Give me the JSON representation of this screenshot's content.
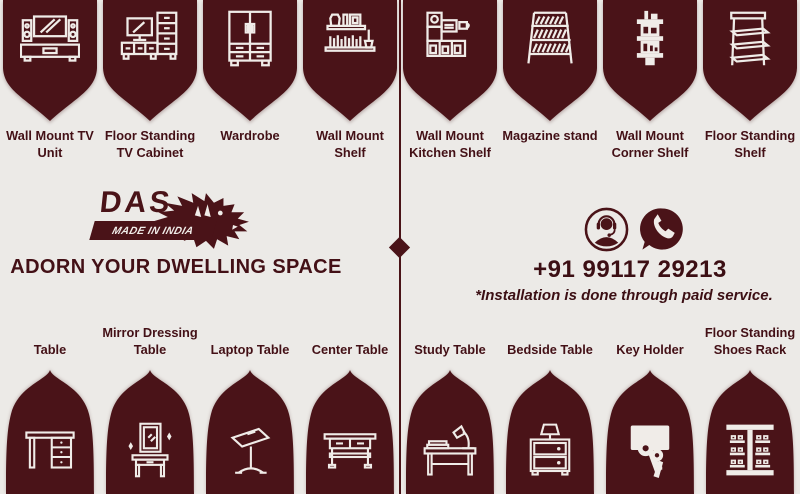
{
  "theme": {
    "maroon": "#4A1318",
    "background": "#ECEAE7",
    "icon_stroke": "#F0ECE8",
    "text_maroon": "#431016"
  },
  "top_categories": [
    {
      "label": "Wall Mount TV Unit",
      "icon": "wall-mount-tv-unit-icon"
    },
    {
      "label": "Floor Standing TV Cabinet",
      "icon": "floor-standing-tv-cabinet-icon"
    },
    {
      "label": "Wardrobe",
      "icon": "wardrobe-icon"
    },
    {
      "label": "Wall Mount Shelf",
      "icon": "wall-mount-shelf-icon"
    },
    {
      "label": "Wall Mount Kitchen Shelf",
      "icon": "wall-mount-kitchen-shelf-icon"
    },
    {
      "label": "Magazine stand",
      "icon": "magazine-stand-icon"
    },
    {
      "label": "Wall Mount Corner Shelf",
      "icon": "wall-mount-corner-shelf-icon"
    },
    {
      "label": "Floor Standing Shelf",
      "icon": "floor-standing-shelf-icon"
    }
  ],
  "bottom_categories": [
    {
      "label": "Table",
      "icon": "table-icon"
    },
    {
      "label": "Mirror Dressing Table",
      "icon": "mirror-dressing-table-icon"
    },
    {
      "label": "Laptop Table",
      "icon": "laptop-table-icon"
    },
    {
      "label": "Center Table",
      "icon": "center-table-icon"
    },
    {
      "label": "Study Table",
      "icon": "study-table-icon"
    },
    {
      "label": "Bedside Table",
      "icon": "bedside-table-icon"
    },
    {
      "label": "Key Holder",
      "icon": "key-holder-icon"
    },
    {
      "label": "Floor Standing Shoes Rack",
      "icon": "floor-standing-shoes-rack-icon"
    }
  ],
  "brand": {
    "logo_text": "DAS",
    "logo_badge": "MADE IN INDIA",
    "logo_mark": "tiger-icon",
    "tagline": "ADORN YOUR DWELLING SPACE"
  },
  "contact": {
    "support_icon": "customer-care-icon",
    "whatsapp_icon": "whatsapp-phone-icon",
    "phone": "+91 99117 29213",
    "note": "*Installation is done through paid service."
  }
}
